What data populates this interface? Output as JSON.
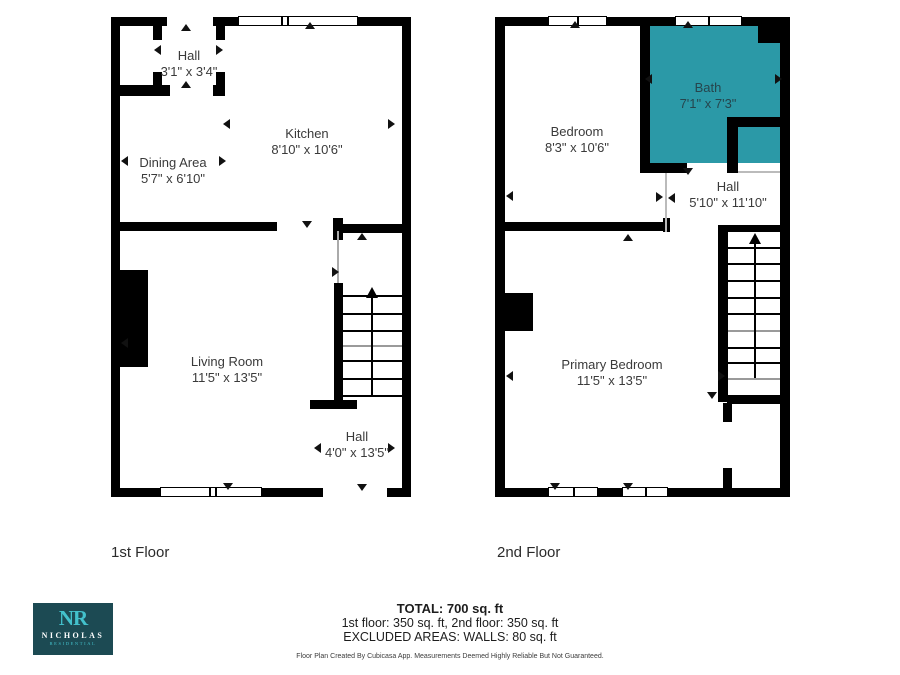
{
  "floors": [
    {
      "label": "1st Floor",
      "rooms": [
        {
          "name": "Hall",
          "dims": "3'1\" x 3'4\""
        },
        {
          "name": "Kitchen",
          "dims": "8'10\" x 10'6\""
        },
        {
          "name": "Dining Area",
          "dims": "5'7\" x 6'10\""
        },
        {
          "name": "Living Room",
          "dims": "11'5\" x 13'5\""
        },
        {
          "name": "Hall",
          "dims": "4'0\" x 13'5\""
        }
      ]
    },
    {
      "label": "2nd Floor",
      "rooms": [
        {
          "name": "Bedroom",
          "dims": "8'3\" x 10'6\""
        },
        {
          "name": "Bath",
          "dims": "7'1\" x 7'3\""
        },
        {
          "name": "Hall",
          "dims": "5'10\" x 11'10\""
        },
        {
          "name": "Primary Bedroom",
          "dims": "11'5\" x 13'5\""
        }
      ]
    }
  ],
  "summary": {
    "total": "TOTAL: 700 sq. ft",
    "floors_line": "1st floor: 350 sq. ft, 2nd floor: 350 sq. ft",
    "excluded": "EXCLUDED AREAS: WALLS: 80 sq. ft",
    "disclaimer": "Floor Plan Created By Cubicasa App. Measurements Deemed Highly Reliable But Not Guaranteed."
  },
  "logo": {
    "monogram": "NR",
    "name": "NICHOLAS",
    "subtitle": "RESIDENTIAL"
  },
  "colors": {
    "wall": "#000000",
    "bath_fill": "#2B99A7",
    "logo_bg": "#1C4A53",
    "logo_accent": "#43C1CC"
  }
}
